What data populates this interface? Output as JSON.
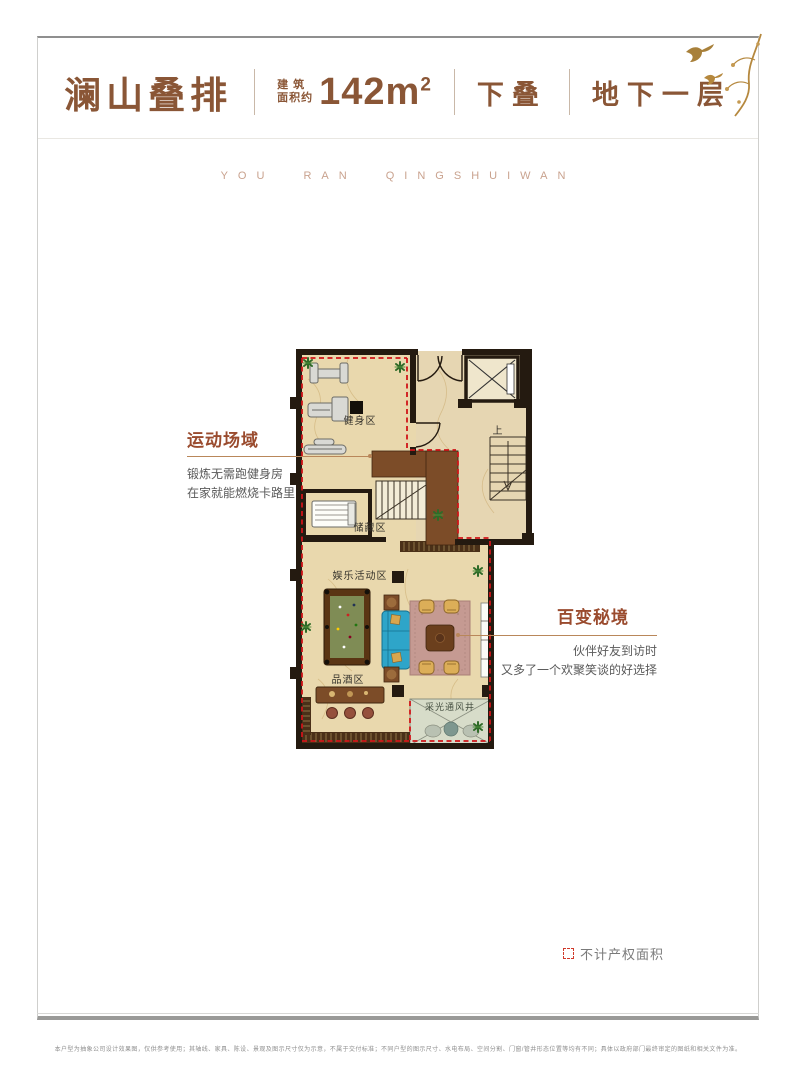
{
  "header": {
    "title": "澜山叠排",
    "area_label_line1": "建 筑",
    "area_label_line2": "面积约",
    "area_value": "142m",
    "area_sup": "2",
    "tag_stack": "下叠",
    "tag_floor": "地下一层"
  },
  "watermark": "YOU RAN QINGSHUIWAN",
  "annotations": {
    "left": {
      "title": "运动场域",
      "line1": "锻炼无需跑健身房",
      "line2": "在家就能燃烧卡路里"
    },
    "right": {
      "title": "百变秘境",
      "line1": "伙伴好友到访时",
      "line2": "又多了一个欢聚笑谈的好选择"
    }
  },
  "plan": {
    "labels": {
      "gym": "健身区",
      "storage": "储藏区",
      "entertainment": "娱乐活动区",
      "wine": "品酒区",
      "vent": "采光通风井",
      "stairs_up": "上"
    }
  },
  "legend": {
    "non_property": "不计产权面积"
  },
  "disclaimer": "本户型为抽象公司设计效果图，仅供参考使用；其轴线、家具、陈设、景观及图示尺寸仅为示意，不属于交付标准；不同户型的图示尺寸、水电布局、空间分割、门窗/管井形态位置等均有不同；具体以政府部门最终审定的图纸和相关文件为准。",
  "colors": {
    "brand_brown": "#8a5636",
    "annotation_red": "#9a4b2e",
    "boundary_red": "#cf1418",
    "leader_tan": "#b9875a",
    "floor_beige": "#e9d8ad",
    "wall_dark": "#241a10"
  }
}
